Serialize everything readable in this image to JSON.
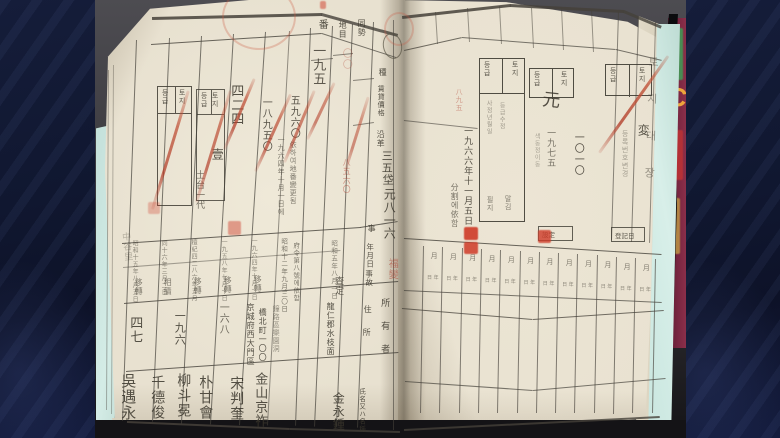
{
  "frame": {
    "bar_color": "#131b36",
    "stripe_color": "#7d91d2"
  },
  "photo": {
    "backdrop_top": "#4d4c51",
    "backdrop_bottom": "#151417",
    "table_mat_color": "#cfe9e2"
  },
  "book": {
    "page_color": "#e8e1d0",
    "grid_color": "#45413a",
    "ink": "#3a362c",
    "faint_ink": "#6f695c",
    "red_ink": "#b04030",
    "seal_red": "#cf3b28"
  },
  "background_book": {
    "letter": "C",
    "letter_color": "#eda53b",
    "cover_color": "#7b2742"
  },
  "edge_labels": {
    "right_strip": "토지대장",
    "left_fore_edge": "中谷里"
  },
  "right_page_date_row": {
    "count": 12,
    "top_char": "月",
    "bottom_chars": "日 年"
  },
  "texts": {
    "left_page": [
      {
        "id": "col-header-lot-number",
        "t": "番",
        "x": 316,
        "y": 19,
        "fs": 10
      },
      {
        "id": "col-header-land-category",
        "t": "地目",
        "x": 338,
        "y": 21,
        "fs": 8
      },
      {
        "id": "col-header-area",
        "t": "同勢",
        "x": 357,
        "y": 19,
        "fs": 8
      },
      {
        "id": "col-header-class",
        "t": "種",
        "x": 378,
        "y": 68,
        "fs": 8
      },
      {
        "id": "col-header-rental-value",
        "t": "賃貸價格",
        "x": 377,
        "y": 85,
        "fs": 7
      },
      {
        "id": "col-header-history",
        "t": "沿革",
        "x": 376,
        "y": 130,
        "fs": 8
      },
      {
        "id": "col-header-item",
        "t": "事",
        "x": 367,
        "y": 224,
        "fs": 8
      },
      {
        "id": "col-header-date",
        "t": "年月日",
        "x": 366,
        "y": 243,
        "fs": 7.5
      },
      {
        "id": "col-header-event",
        "t": "事故",
        "x": 365,
        "y": 270,
        "fs": 7.5
      },
      {
        "id": "col-header-address-1",
        "t": "住",
        "x": 363,
        "y": 305,
        "fs": 8
      },
      {
        "id": "col-header-address-2",
        "t": "所",
        "x": 362,
        "y": 328,
        "fs": 8
      },
      {
        "id": "col-header-owner",
        "t": "所有者",
        "x": 379,
        "y": 298,
        "fs": 9,
        "ls": 14
      },
      {
        "id": "col-header-name",
        "t": "氏名又ハ名稱",
        "x": 358,
        "y": 388,
        "fs": 6.5
      },
      {
        "t": "〇〇",
        "x": 340,
        "y": 48,
        "fs": 10,
        "c": "red",
        "o": 0.3
      },
      {
        "t": "一九五",
        "x": 311,
        "y": 44,
        "fs": 13,
        "o": 0.8
      },
      {
        "t": "四二四",
        "x": 229,
        "y": 84,
        "fs": 13
      },
      {
        "t": "一八九五〇",
        "x": 260,
        "y": 97,
        "fs": 10
      },
      {
        "t": "五九六〇",
        "x": 288,
        "y": 95,
        "fs": 10
      },
      {
        "t": "壹",
        "x": 211,
        "y": 148,
        "fs": 12
      },
      {
        "t": "土台一代",
        "x": 194,
        "y": 170,
        "fs": 9,
        "o": 0.7
      },
      {
        "t": "一九六四年十月一日에",
        "x": 277,
        "y": 136,
        "fs": 7,
        "o": 0.62
      },
      {
        "t": "依하여地番變更됨",
        "x": 289,
        "y": 141,
        "fs": 7,
        "o": 0.62
      },
      {
        "t": "八五六〇",
        "x": 342,
        "y": 158,
        "fs": 8,
        "c": "red",
        "o": 0.5
      },
      {
        "t": "三五",
        "x": 381,
        "y": 150,
        "fs": 11
      },
      {
        "t": "垈",
        "x": 382,
        "y": 174,
        "fs": 11
      },
      {
        "t": "元八一六",
        "x": 383,
        "y": 188,
        "fs": 12
      },
      {
        "t": "福變",
        "x": 386,
        "y": 258,
        "fs": 10,
        "c": "red",
        "o": 0.55
      },
      {
        "t": "昭和十五年八月五日",
        "x": 131,
        "y": 240,
        "fs": 6,
        "o": 0.55
      },
      {
        "t": "移轉",
        "x": 134,
        "y": 278,
        "fs": 8,
        "o": 0.6
      },
      {
        "t": "同十六年三月二日",
        "x": 160,
        "y": 240,
        "fs": 6,
        "o": 0.55
      },
      {
        "t": "相續",
        "x": 163,
        "y": 278,
        "fs": 8,
        "o": 0.6
      },
      {
        "t": "檀紀四二八六年五月",
        "x": 190,
        "y": 239,
        "fs": 6,
        "o": 0.55
      },
      {
        "t": "移轉",
        "x": 193,
        "y": 277,
        "fs": 8,
        "o": 0.6
      },
      {
        "t": "一九五八年七月十日",
        "x": 220,
        "y": 239,
        "fs": 6,
        "o": 0.55
      },
      {
        "t": "移轉",
        "x": 223,
        "y": 276,
        "fs": 8,
        "o": 0.6
      },
      {
        "t": "一九六四年十月一日",
        "x": 250,
        "y": 238,
        "fs": 6,
        "o": 0.55
      },
      {
        "t": "移轉",
        "x": 253,
        "y": 275,
        "fs": 8,
        "o": 0.6
      },
      {
        "t": "昭和十二年九月三〇日",
        "x": 280,
        "y": 238,
        "fs": 6.5,
        "o": 0.65
      },
      {
        "t": "府令第八號에依함",
        "x": 292,
        "y": 242,
        "fs": 6.5,
        "o": 0.65
      },
      {
        "t": "昭和五年八月一日",
        "x": 330,
        "y": 240,
        "fs": 6.5,
        "o": 0.6
      },
      {
        "t": "査定",
        "x": 333,
        "y": 276,
        "fs": 9,
        "o": 0.75
      },
      {
        "id": "area-value-1",
        "t": "四七",
        "x": 128,
        "y": 316,
        "fs": 13
      },
      {
        "id": "area-value-2",
        "t": "一九六",
        "x": 174,
        "y": 310,
        "fs": 11
      },
      {
        "id": "area-value-3",
        "t": "一六八",
        "x": 217,
        "y": 302,
        "fs": 10,
        "o": 0.7
      },
      {
        "id": "owner-address-1",
        "t": "京城府西大門區",
        "x": 246,
        "y": 303,
        "fs": 8
      },
      {
        "id": "owner-address-2",
        "t": "橋北町一〇〇",
        "x": 258,
        "y": 308,
        "fs": 8
      },
      {
        "t": "鐘路區樂園洞",
        "x": 272,
        "y": 305,
        "fs": 7,
        "o": 0.5
      },
      {
        "id": "owner-address-3",
        "t": "龍仁郡水枝面",
        "x": 326,
        "y": 302,
        "fs": 8
      },
      {
        "id": "owner-name-6",
        "t": "吳遇永",
        "x": 120,
        "y": 373,
        "fs": 15
      },
      {
        "id": "owner-name-5",
        "t": "千德俊",
        "x": 150,
        "y": 375,
        "fs": 14
      },
      {
        "id": "owner-name-4",
        "t": "柳斗冕",
        "x": 176,
        "y": 373,
        "fs": 14
      },
      {
        "id": "owner-name-3",
        "t": "朴甘會",
        "x": 198,
        "y": 375,
        "fs": 14
      },
      {
        "id": "owner-name-2",
        "t": "宋判奎",
        "x": 229,
        "y": 376,
        "fs": 14
      },
      {
        "id": "owner-name-1",
        "t": "金山京祚",
        "x": 253,
        "y": 372,
        "fs": 13
      },
      {
        "id": "owner-name-0",
        "t": "金永鍾",
        "x": 332,
        "y": 392,
        "fs": 12
      }
    ],
    "right_page": [
      {
        "id": "division-note-date",
        "t": "一九六六年十一月五日",
        "x": 462,
        "y": 126,
        "fs": 9
      },
      {
        "t": "分割에依함",
        "x": 450,
        "y": 183,
        "fs": 8,
        "o": 0.65
      },
      {
        "t": "一九七五",
        "x": 545,
        "y": 128,
        "fs": 9,
        "o": 0.65
      },
      {
        "t": "一〇一〇",
        "x": 572,
        "y": 132,
        "fs": 10
      },
      {
        "t": "색동정이동",
        "x": 533,
        "y": 133,
        "fs": 6,
        "o": 0.4
      },
      {
        "id": "grade-entry",
        "t": "元",
        "x": 540,
        "y": 90,
        "fs": 18,
        "rot": 6
      },
      {
        "id": "grade-change-mark",
        "t": "変",
        "x": 637,
        "y": 124,
        "fs": 12
      },
      {
        "t": "八九五",
        "x": 455,
        "y": 88,
        "fs": 7,
        "c": "red",
        "o": 0.45
      },
      {
        "t": "등록번호변경",
        "x": 621,
        "y": 130,
        "fs": 7,
        "o": 0.4
      },
      {
        "t": "사정년월일",
        "x": 485,
        "y": 100,
        "fs": 6,
        "o": 0.45
      },
      {
        "t": "등급수정",
        "x": 498,
        "y": 102,
        "fs": 6,
        "o": 0.45
      },
      {
        "t": "필지",
        "x": 486,
        "y": 196,
        "fs": 7,
        "o": 0.6
      },
      {
        "t": "말김",
        "x": 504,
        "y": 195,
        "fs": 7,
        "o": 0.6
      }
    ]
  },
  "marks": {
    "stamp_boxes": [
      {
        "id": "grade-stamp-left-a",
        "x": 157,
        "y": 86,
        "w": 35,
        "h": 120,
        "hh": 26,
        "left": "등급",
        "right": "토지",
        "o": 0.85
      },
      {
        "id": "grade-stamp-left-b",
        "x": 196,
        "y": 89,
        "w": 29,
        "h": 112,
        "hh": 24,
        "left": "등급",
        "right": "토지",
        "o": 0.8
      },
      {
        "id": "grade-stamp-right-1",
        "x": 479,
        "y": 58,
        "w": 46,
        "h": 164,
        "hh": 34,
        "left": "등급",
        "right": "토지",
        "o": 0.9
      },
      {
        "id": "grade-stamp-right-2",
        "x": 529,
        "y": 68,
        "w": 45,
        "h": 30,
        "hh": 30,
        "left": "등급",
        "right": "토지",
        "o": 0.9
      },
      {
        "id": "grade-stamp-right-3",
        "x": 605,
        "y": 64,
        "w": 47,
        "h": 32,
        "hh": 32,
        "left": "등급",
        "right": "토지",
        "o": 0.9
      },
      {
        "id": "label-box-set",
        "x": 538,
        "y": 226,
        "w": 35,
        "h": 15,
        "hh": 15,
        "single": "設定",
        "o": 0.8
      },
      {
        "id": "label-box-registry",
        "x": 611,
        "y": 227,
        "w": 34,
        "h": 15,
        "hh": 15,
        "single": "登記日",
        "o": 0.8
      }
    ],
    "red_slashes": [
      {
        "x1": 151,
        "y1": 209,
        "x2": 187,
        "y2": 90,
        "w": 3,
        "o": 0.75
      },
      {
        "x1": 195,
        "y1": 202,
        "x2": 229,
        "y2": 90,
        "w": 3,
        "o": 0.7
      },
      {
        "x1": 223,
        "y1": 149,
        "x2": 253,
        "y2": 78,
        "w": 2.5,
        "o": 0.75
      },
      {
        "x1": 254,
        "y1": 171,
        "x2": 289,
        "y2": 94,
        "w": 2.5,
        "o": 0.7
      },
      {
        "x1": 283,
        "y1": 162,
        "x2": 313,
        "y2": 90,
        "w": 2.5,
        "o": 0.65
      },
      {
        "x1": 306,
        "y1": 139,
        "x2": 333,
        "y2": 82,
        "w": 2.5,
        "o": 0.6
      },
      {
        "x1": 344,
        "y1": 170,
        "x2": 367,
        "y2": 96,
        "w": 2.5,
        "o": 0.55
      },
      {
        "x1": 598,
        "y1": 152,
        "x2": 667,
        "y2": 55,
        "w": 3,
        "o": 0.8
      }
    ],
    "seals": [
      {
        "id": "red-seal-top",
        "x": 464,
        "y": 227,
        "w": 14,
        "h": 13,
        "o": 0.9
      },
      {
        "id": "red-seal-bottom",
        "x": 464,
        "y": 242,
        "w": 14,
        "h": 12,
        "o": 0.85
      },
      {
        "id": "red-seal-small",
        "x": 538,
        "y": 230,
        "w": 13,
        "h": 13,
        "o": 0.8
      },
      {
        "id": "red-seal-faint-1",
        "x": 228,
        "y": 221,
        "w": 13,
        "h": 14,
        "o": 0.45
      },
      {
        "id": "red-seal-faint-2",
        "x": 148,
        "y": 202,
        "w": 12,
        "h": 12,
        "o": 0.3
      }
    ],
    "rings": [
      {
        "x": 222,
        "y": -16,
        "w": 70,
        "h": 62,
        "o": 0.32
      },
      {
        "x": 384,
        "y": 12,
        "w": 26,
        "h": 30,
        "o": 0.3
      }
    ],
    "red_dot": {
      "x": 320,
      "y": 1,
      "w": 6,
      "h": 8,
      "o": 0.5
    }
  }
}
